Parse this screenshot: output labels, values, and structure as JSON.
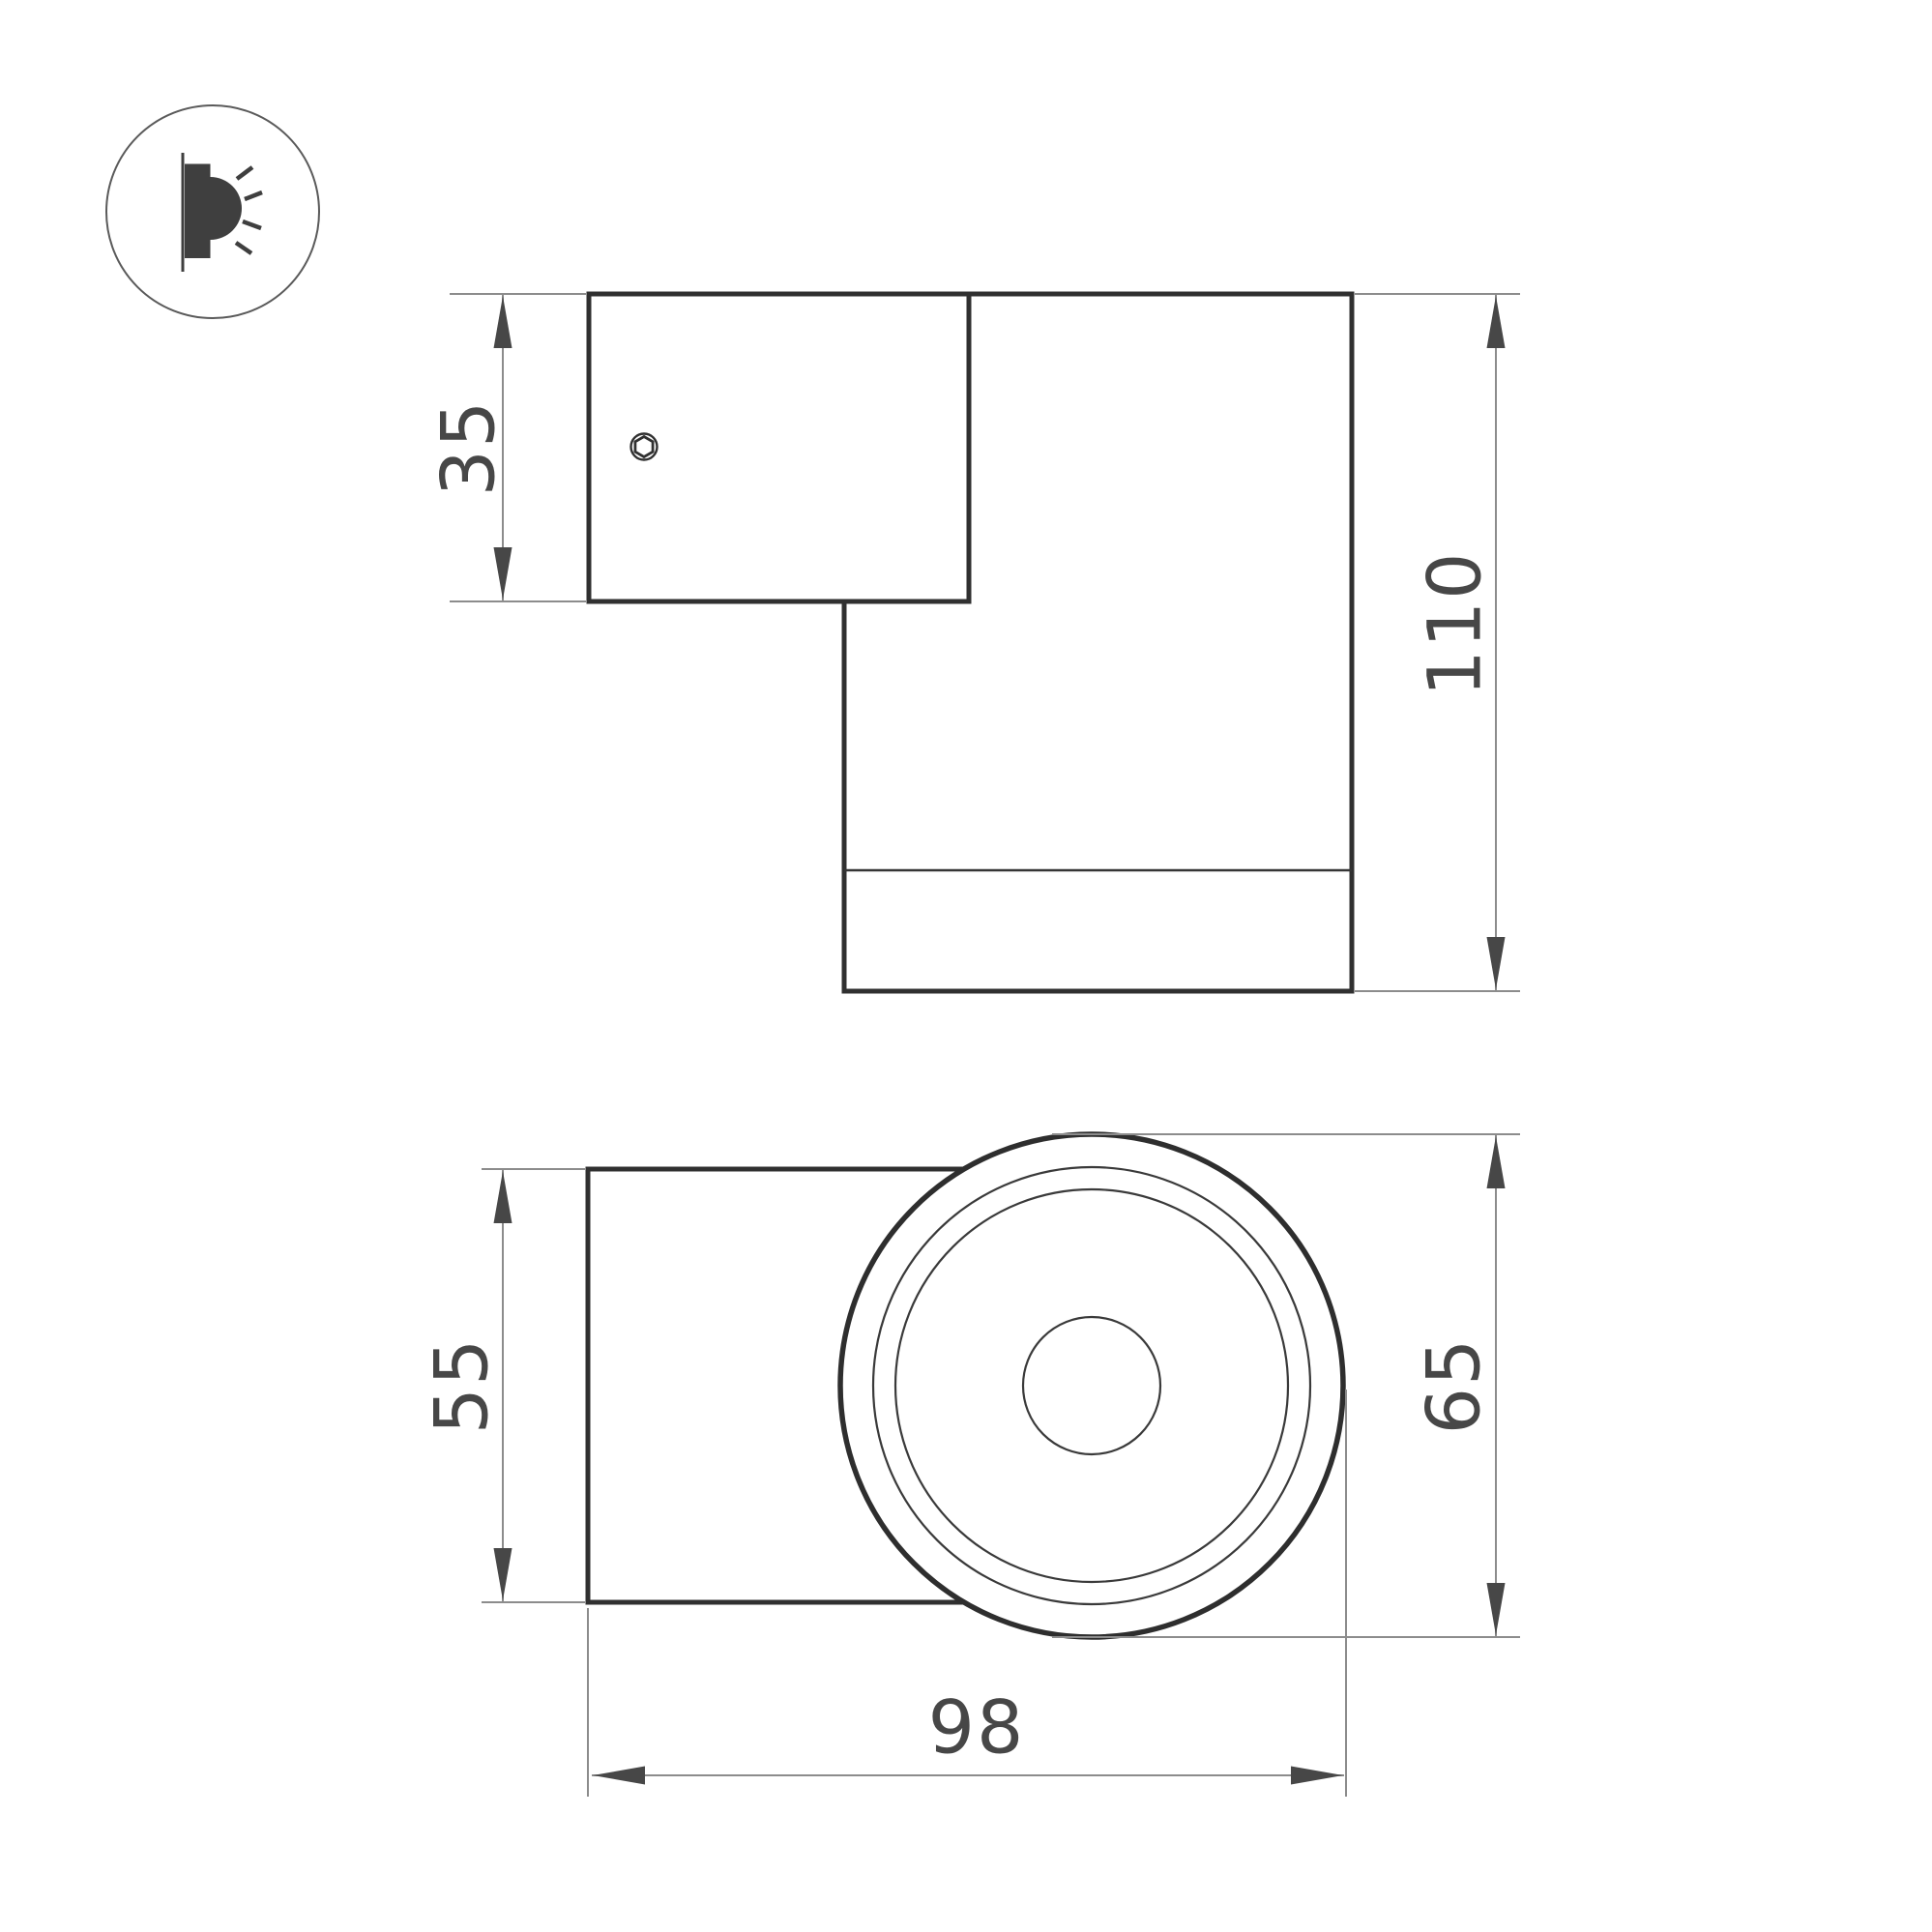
{
  "icon": {
    "name": "wall-light-side-glow-icon"
  },
  "side_view": {
    "name": "side view",
    "mount_plate_height": "35",
    "total_height": "110"
  },
  "front_view": {
    "name": "front view",
    "body_depth": "55",
    "lens_diameter": "65",
    "total_width": "98"
  },
  "colors": {
    "background": "#ffffff",
    "outline": "#303030",
    "icon_fill": "#3f3f3f",
    "dimension_line": "#8c8c8c",
    "dimension_text": "#474747"
  }
}
